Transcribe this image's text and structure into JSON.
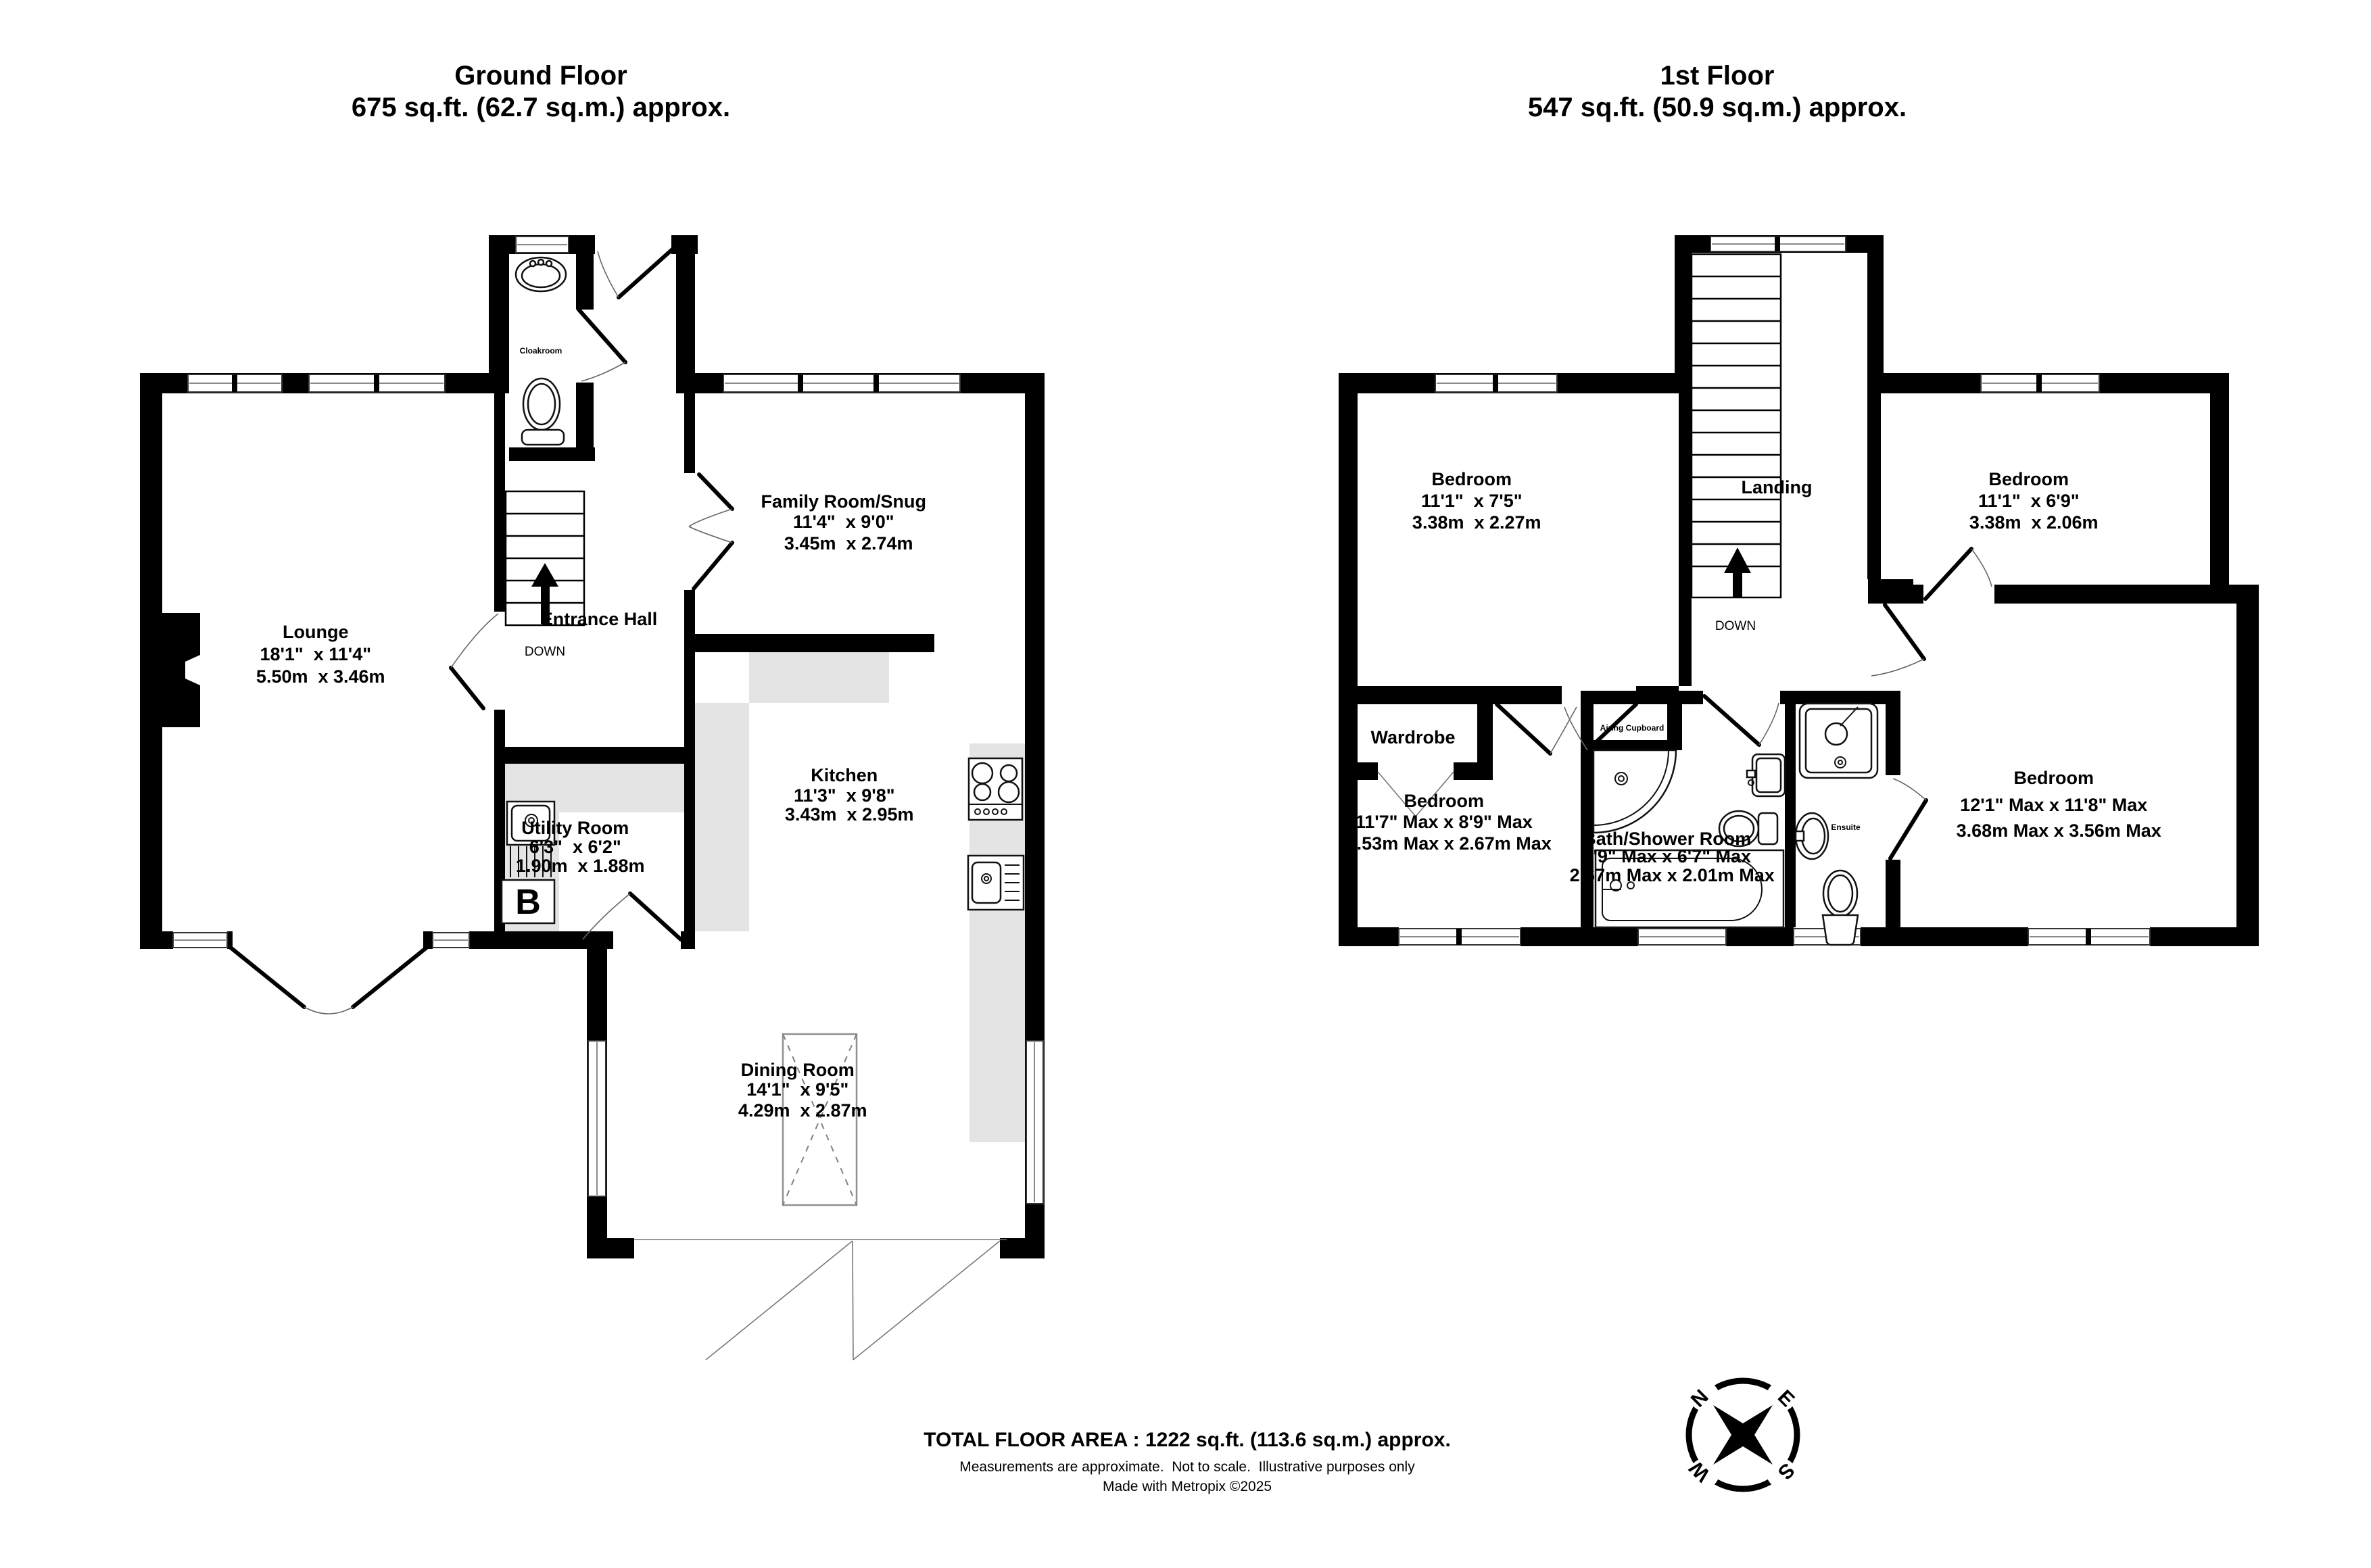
{
  "ground_floor": {
    "title_line1": "Ground Floor",
    "title_line2": "675 sq.ft. (62.7 sq.m.) approx.",
    "rooms": {
      "lounge": {
        "name": "Lounge",
        "imperial": "18'1\"  x 11'4\"",
        "metric": "5.50m  x 3.46m"
      },
      "family": {
        "name": "Family Room/Snug",
        "imperial": "11'4\"  x 9'0\"",
        "metric": "3.45m  x 2.74m"
      },
      "kitchen": {
        "name": "Kitchen",
        "imperial": "11'3\"  x 9'8\"",
        "metric": "3.43m  x 2.95m"
      },
      "utility": {
        "name": "Utility Room",
        "imperial": "6'3\"  x 6'2\"",
        "metric": "1.90m  x 1.88m"
      },
      "dining": {
        "name": "Dining Room",
        "imperial": "14'1\"  x 9'5\"",
        "metric": "4.29m  x 2.87m"
      },
      "entrance_hall": {
        "name": "Entrance Hall"
      },
      "cloakroom": {
        "name": "Cloakroom"
      }
    },
    "labels": {
      "down": "DOWN",
      "boiler": "B"
    }
  },
  "first_floor": {
    "title_line1": "1st Floor",
    "title_line2": "547 sq.ft. (50.9 sq.m.) approx.",
    "rooms": {
      "bedroom_top_left": {
        "name": "Bedroom",
        "imperial": "11'1\"  x 7'5\"",
        "metric": "3.38m  x 2.27m"
      },
      "bedroom_top_right": {
        "name": "Bedroom",
        "imperial": "11'1\"  x 6'9\"",
        "metric": "3.38m  x 2.06m"
      },
      "bedroom_bottom_left": {
        "name": "Bedroom",
        "imperial": "11'7\" Max x 8'9\" Max",
        "metric": "3.53m Max x 2.67m Max"
      },
      "bedroom_bottom_right": {
        "name": "Bedroom",
        "imperial": "12'1\" Max x 11'8\" Max",
        "metric": "3.68m Max x 3.56m Max"
      },
      "bath_shower": {
        "name": "Bath/Shower Room",
        "imperial": "8'9\" Max x 6'7\" Max",
        "metric": "2.67m Max x 2.01m Max"
      },
      "landing": {
        "name": "Landing"
      },
      "wardrobe": {
        "name": "Wardrobe"
      },
      "airing": {
        "name": "Airing Cupboard"
      },
      "ensuite": {
        "name": "Ensuite"
      }
    },
    "labels": {
      "down": "DOWN"
    }
  },
  "footer": {
    "total_area": "TOTAL FLOOR AREA : 1222 sq.ft. (113.6 sq.m.) approx.",
    "disclaimer": "Measurements are approximate.  Not to scale.  Illustrative purposes only",
    "credit": "Made with Metropix ©2025"
  },
  "compass": {
    "n": "N",
    "e": "E",
    "s": "S",
    "w": "W"
  }
}
